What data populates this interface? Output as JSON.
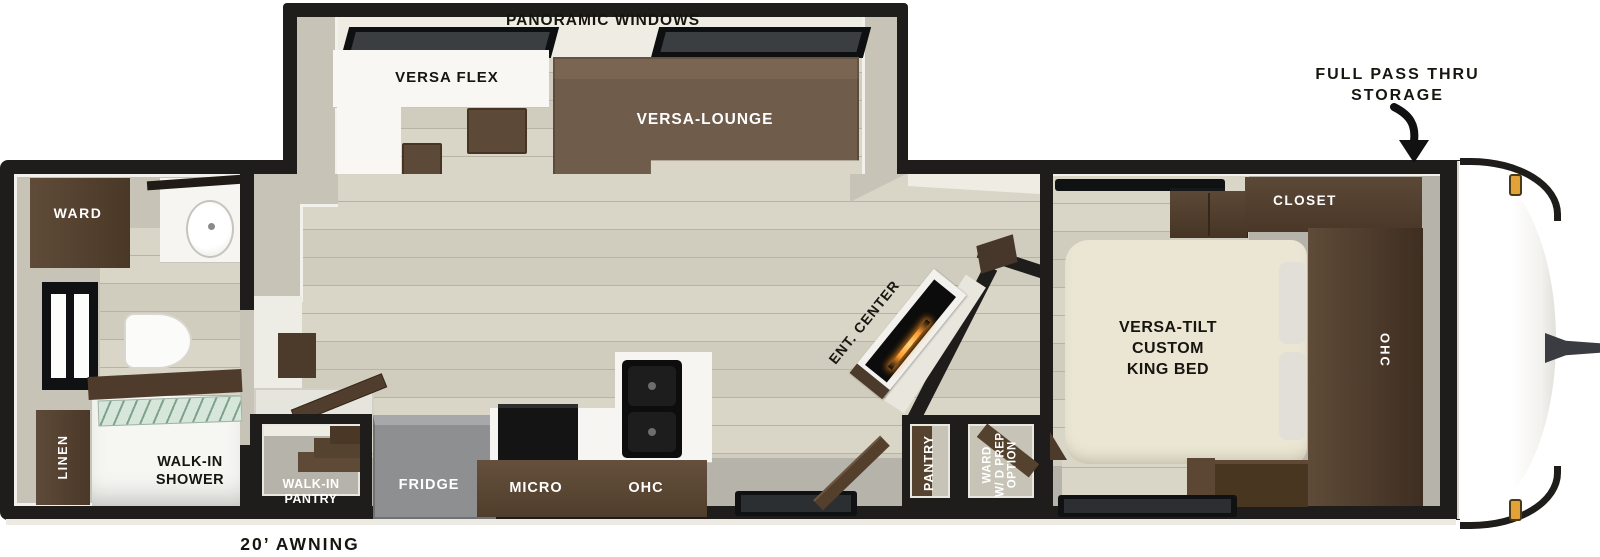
{
  "exterior": {
    "panoramic_windows": "PANORAMIC WINDOWS",
    "full_pass_thru_storage": "FULL PASS THRU\nSTORAGE",
    "awning": "20’ AWNING"
  },
  "living": {
    "versa_flex": "VERSA FLEX",
    "versa_lounge": "VERSA-LOUNGE",
    "ent_center": "ENT. CENTER",
    "pantry": "PANTRY",
    "ward_wd_prep_option": "WARD\nW/ D PREP\nOPTION"
  },
  "kitchen": {
    "walk_in_pantry": "WALK-IN\nPANTRY",
    "fridge": "FRIDGE",
    "micro": "MICRO",
    "ohc": "OHC"
  },
  "bathroom": {
    "ward": "WARD",
    "linen": "LINEN",
    "walk_in_shower": "WALK-IN\nSHOWER"
  },
  "bedroom": {
    "bed": "VERSA-TILT\nCUSTOM\nKING BED",
    "closet": "CLOSET",
    "ohc": "OHC"
  },
  "colors": {
    "wall": "#1e1d1b",
    "floor_wood": "#d6d2c4",
    "floor_gray": "#b5b3aa",
    "cabinet_dark": "#4a3827",
    "cabinet_mid": "#5d4937",
    "lounge": "#705c4b",
    "bed": "#eae6d3",
    "counter_white": "#f6f5f1",
    "fireplace_glow": "#ff9a2e",
    "marker_light": "#e2a238"
  }
}
